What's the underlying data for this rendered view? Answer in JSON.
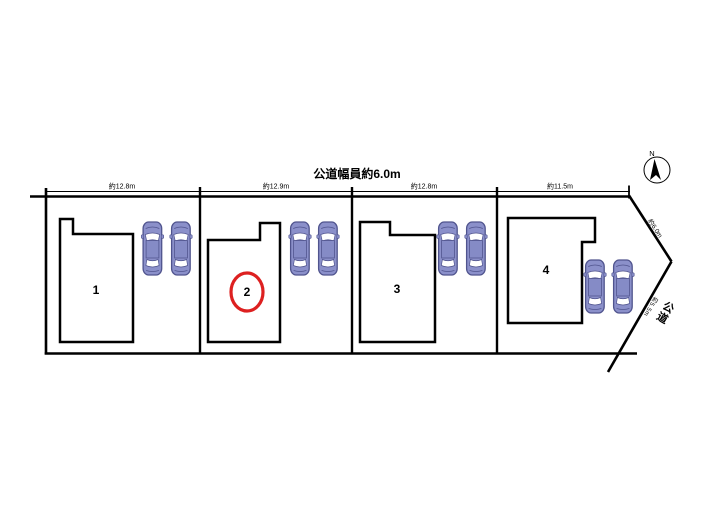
{
  "title": "公道幅員約6.0m",
  "compass": {
    "north_label": "N"
  },
  "dimension_labels": [
    "約12.8m",
    "約12.9m",
    "約12.8m",
    "約11.5m"
  ],
  "lots": [
    {
      "number": "1",
      "highlighted": false
    },
    {
      "number": "2",
      "highlighted": true
    },
    {
      "number": "3",
      "highlighted": false
    },
    {
      "number": "4",
      "highlighted": false
    }
  ],
  "highlighted_lot": "2",
  "road": {
    "name": "公道",
    "upper_edge_label": "約6.0m",
    "lower_edge_label": "約5.5m"
  },
  "cars_per_lot": 2,
  "colors": {
    "line": "#000000",
    "highlight_circle": "#dd2020",
    "car_body": "#8b90ca",
    "car_outline": "#50548e",
    "background": "#ffffff"
  }
}
